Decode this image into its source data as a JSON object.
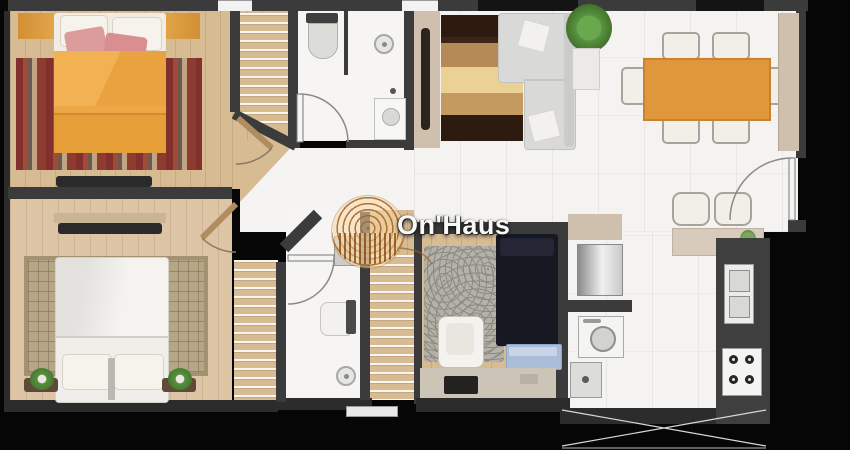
{
  "watermark": {
    "brand": "On'Haus",
    "logo": "yarn-spiral-logo"
  },
  "palette": {
    "background": "#060606",
    "wall": "#3b3b3b",
    "wall_dark": "#2c2c2c",
    "wood": "#d7bb92",
    "wood_light": "#dcc4a4",
    "white_floor": "#f4f3f1",
    "orange_bed": "#eda845",
    "orange_table": "#e0973c",
    "rug_red": "#8e3b30",
    "rug_sisal": "#b5a687",
    "sofa_gray": "#d9d9d7",
    "navy_bed": "#171922",
    "bench_blue": "#a9bdd9",
    "beige_cabinet": "#cfc0ae",
    "counter_dark": "#3f3f3f",
    "plant_green": "#57913f",
    "watermark_text": "#f8f8f6"
  },
  "floor_plan": {
    "rooms": [
      {
        "name": "bedroom-1",
        "furniture": [
          "double-bed-orange-duvet",
          "pink-pillows",
          "striped-red-rug",
          "open-wardrobe-shelves",
          "tv-console",
          "door-arc"
        ]
      },
      {
        "name": "bedroom-2",
        "furniture": [
          "double-bed-white",
          "sisal-grid-rug",
          "bedside-plants",
          "tv-console",
          "open-wardrobe-shelves",
          "door-arc"
        ]
      },
      {
        "name": "bathroom-1",
        "furniture": [
          "toilet",
          "shower-drain",
          "washbasin",
          "door-arc"
        ]
      },
      {
        "name": "bathroom-2",
        "furniture": [
          "toilet",
          "shower-drain",
          "washbasin",
          "door-arc"
        ]
      },
      {
        "name": "living-room",
        "furniture": [
          "l-shaped-sofa",
          "striped-brown-rug",
          "tv-sideboard",
          "potted-plant"
        ]
      },
      {
        "name": "dining-room",
        "furniture": [
          "orange-dining-table",
          "six-chairs",
          "wall-cabinet",
          "entry-door-arc",
          "bar-stools",
          "pass-through-counter"
        ]
      },
      {
        "name": "bedroom-3",
        "furniture": [
          "double-bed-dark",
          "circle-pattern-rug",
          "armchair",
          "foot-bench",
          "dresser-with-tv",
          "wardrobe-shelves"
        ]
      },
      {
        "name": "kitchen",
        "furniture": [
          "refrigerator",
          "washing-machine",
          "small-appliance",
          "double-sink",
          "four-burner-stove",
          "counter-cabinets"
        ]
      }
    ],
    "outside": [
      "black-surround",
      "hatched-shaft-area",
      "windows-top-wall"
    ]
  }
}
